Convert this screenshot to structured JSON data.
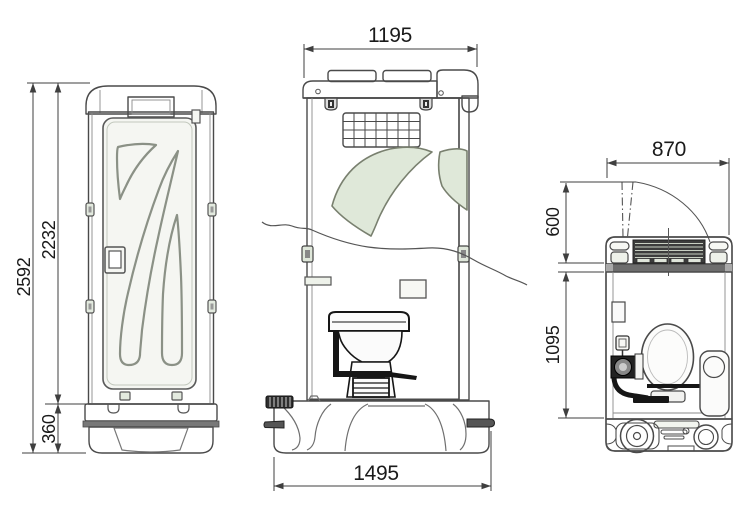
{
  "drawing": {
    "subject": "portable-toilet-three-view-technical-drawing"
  },
  "dimensions": {
    "front_overall_height": "2592",
    "front_cabin_height": "2232",
    "front_base_height": "360",
    "side_roof_width": "1195",
    "side_base_width": "1495",
    "plan_overall_width": "870",
    "plan_door_swing_depth": "600",
    "plan_interior_depth": "1095"
  },
  "colors": {
    "wall_green": "#e3eadf",
    "door_white": "#f5f6f2",
    "base_gray": "#f1f2ee",
    "interior_gray": "#ededed",
    "threshold_gray": "#6d6d6d",
    "line": "#3f3f3f",
    "detail_black": "#161616"
  }
}
